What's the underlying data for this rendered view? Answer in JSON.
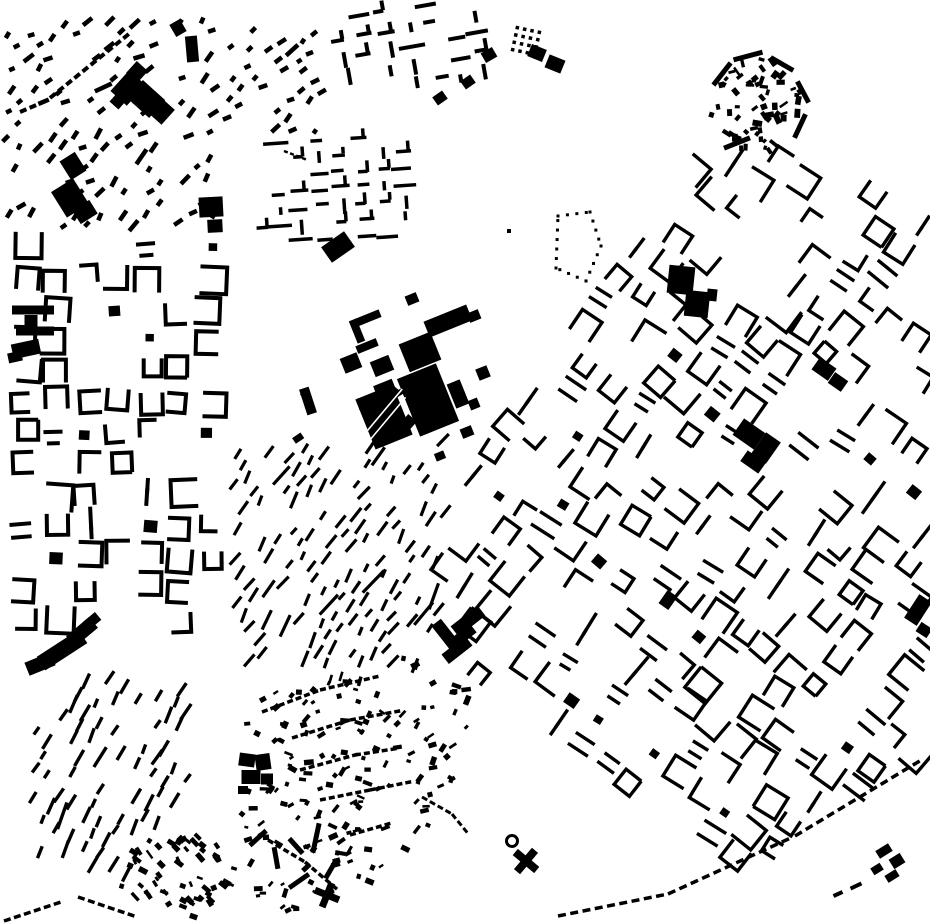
{
  "map": {
    "type": "figure-ground-building-footprints",
    "width": 930,
    "height": 924,
    "background": "#ffffff",
    "building_color": "#000000",
    "districts": [
      {
        "name": "topleft-scatter",
        "type": "bars",
        "seed": 11,
        "bbox": [
          5,
          15,
          210,
          218
        ],
        "grid_angle": -42,
        "cell": [
          17,
          15
        ],
        "bar": [
          9,
          4.5
        ],
        "bar_angle": -42,
        "bar_angle_jitter": 26,
        "density": 0.5
      },
      {
        "name": "topleft-east-cluster",
        "type": "bars",
        "seed": 12,
        "bbox": [
          226,
          22,
          96,
          114
        ],
        "grid_angle": -38,
        "cell": [
          15,
          13
        ],
        "bar": [
          7,
          4.5
        ],
        "bar_angle": -38,
        "bar_angle_jitter": 20,
        "density": 0.52
      },
      {
        "name": "topcenter-bars",
        "type": "bars_cross",
        "seed": 13,
        "bbox": [
          336,
          4,
          150,
          84
        ],
        "grid_angle": -10,
        "cell": [
          23,
          19
        ],
        "bar_len": 18,
        "bar_th": 4,
        "density": 0.85
      },
      {
        "name": "north-maze",
        "type": "bars_cross",
        "seed": 14,
        "bbox": [
          262,
          136,
          158,
          104
        ],
        "grid_angle": -4,
        "cell": [
          21,
          17
        ],
        "bar_len": 17,
        "bar_th": 3.5,
        "density": 0.82
      },
      {
        "name": "village-core-ne",
        "type": "scatter",
        "seed": 15,
        "ellipse": [
          757,
          104,
          48,
          50
        ],
        "count": 64,
        "size": [
          6.5,
          4
        ],
        "angle": 0,
        "angle_jitter": 90
      },
      {
        "name": "west-perimeter",
        "type": "perimeter",
        "seed": 16,
        "bbox": [
          5,
          243,
          226,
          380
        ],
        "grid_angle": 0,
        "cell": [
          31,
          31
        ],
        "block": 22,
        "stroke": 4,
        "density": 0.74,
        "dash_ratio": 0.22
      },
      {
        "name": "center-hatch",
        "type": "bars",
        "seed": 17,
        "bbox": [
          232,
          438,
          214,
          228
        ],
        "grid_angle": -27,
        "cell": [
          16,
          13.5
        ],
        "bar": [
          13,
          3.2
        ],
        "bar_angle": -58,
        "bar_angle_jitter": 13,
        "density": 0.55
      },
      {
        "name": "main-fabric",
        "type": "perimeter",
        "seed": 18,
        "polygon": [
          [
            426,
            565
          ],
          [
            500,
            420
          ],
          [
            548,
            335
          ],
          [
            600,
            255
          ],
          [
            648,
            215
          ],
          [
            698,
            150
          ],
          [
            745,
            148
          ],
          [
            800,
            160
          ],
          [
            930,
            205
          ],
          [
            930,
            758
          ],
          [
            845,
            800
          ],
          [
            790,
            838
          ],
          [
            745,
            868
          ],
          [
            690,
            852
          ],
          [
            600,
            798
          ],
          [
            520,
            725
          ],
          [
            452,
            648
          ]
        ],
        "grid_angle": 36,
        "cell": [
          31,
          31
        ],
        "block": 21,
        "stroke": 3.4,
        "density": 0.68,
        "dash_ratio": 0.3
      },
      {
        "name": "southwest-rows",
        "type": "bars",
        "seed": 19,
        "polygon": [
          [
            25,
            742
          ],
          [
            95,
            672
          ],
          [
            186,
            690
          ],
          [
            190,
            784
          ],
          [
            130,
            882
          ],
          [
            38,
            854
          ]
        ],
        "grid_angle": 32,
        "cell": [
          17,
          14
        ],
        "bar": [
          14,
          3.4
        ],
        "bar_angle": -62,
        "bar_angle_jitter": 9,
        "density": 0.62
      },
      {
        "name": "south-village",
        "type": "scatter",
        "seed": 20,
        "polygon": [
          [
            255,
            700
          ],
          [
            330,
            668
          ],
          [
            420,
            652
          ],
          [
            468,
            682
          ],
          [
            470,
            770
          ],
          [
            425,
            855
          ],
          [
            345,
            915
          ],
          [
            262,
            915
          ],
          [
            238,
            835
          ],
          [
            233,
            765
          ]
        ],
        "count": 175,
        "size": [
          6.5,
          3.8
        ],
        "angle": -20,
        "angle_jitter": 55
      },
      {
        "name": "south-corner-cluster",
        "type": "scatter",
        "seed": 21,
        "ellipse": [
          178,
          876,
          60,
          44
        ],
        "count": 58,
        "size": [
          7,
          4
        ],
        "angle": 42,
        "angle_jitter": 26
      },
      {
        "name": "center-gap-squares",
        "type": "scatter",
        "seed": 22,
        "bbox": [
          292,
          384,
          130,
          86
        ],
        "count": 7,
        "size": [
          10,
          9
        ],
        "angle": -20,
        "angle_jitter": 30
      }
    ],
    "landmarks": {
      "rects": [
        [
          448,
          321,
          46,
          17,
          -22
        ],
        [
          368,
          318,
          26,
          8,
          -22
        ],
        [
          357,
          331,
          8,
          24,
          -22
        ],
        [
          367,
          346,
          22,
          8,
          -22
        ],
        [
          351,
          363,
          18,
          16,
          -22
        ],
        [
          382,
          366,
          20,
          16,
          -22
        ],
        [
          385,
          389,
          20,
          14,
          -22
        ],
        [
          420,
          352,
          34,
          30,
          -22
        ],
        [
          428,
          400,
          42,
          62,
          -22
        ],
        [
          458,
          394,
          14,
          26,
          -22
        ],
        [
          474,
          316,
          12,
          10,
          -22
        ],
        [
          483,
          373,
          12,
          12,
          -22
        ],
        [
          474,
          404,
          10,
          10,
          -22
        ],
        [
          467,
          432,
          12,
          10,
          -22
        ],
        [
          440,
          456,
          10,
          8,
          -22
        ],
        [
          412,
          299,
          12,
          10,
          -22
        ],
        [
          368,
          404,
          18,
          9,
          -22
        ],
        [
          128,
          88,
          22,
          28,
          42
        ],
        [
          146,
          99,
          30,
          24,
          42
        ],
        [
          137,
          72,
          15,
          16,
          42
        ],
        [
          160,
          110,
          22,
          20,
          42
        ],
        [
          118,
          101,
          12,
          12,
          42
        ],
        [
          73,
          166,
          18,
          22,
          -32
        ],
        [
          70,
          198,
          26,
          30,
          -32
        ],
        [
          85,
          212,
          20,
          16,
          -32
        ],
        [
          192,
          49,
          12,
          26,
          -5
        ],
        [
          211,
          207,
          24,
          20,
          -3
        ],
        [
          215,
          226,
          15,
          13,
          -3
        ],
        [
          178,
          28,
          12,
          14,
          -30
        ],
        [
          33,
          310,
          42,
          9,
          0
        ],
        [
          31,
          321,
          13,
          12,
          0
        ],
        [
          35,
          331,
          38,
          9,
          0
        ],
        [
          26,
          349,
          28,
          15,
          -12
        ],
        [
          15,
          357,
          14,
          10,
          -12
        ],
        [
          62,
          650,
          50,
          16,
          -33
        ],
        [
          40,
          664,
          28,
          14,
          -22
        ],
        [
          82,
          632,
          30,
          14,
          -40
        ],
        [
          92,
          621,
          16,
          10,
          -40
        ],
        [
          468,
          621,
          34,
          13,
          -38
        ],
        [
          463,
          636,
          26,
          11,
          -38
        ],
        [
          457,
          650,
          30,
          12,
          -38
        ],
        [
          446,
          635,
          12,
          32,
          -38
        ],
        [
          749,
          434,
          26,
          20,
          35
        ],
        [
          766,
          448,
          18,
          26,
          35
        ],
        [
          753,
          462,
          22,
          13,
          35
        ],
        [
          824,
          369,
          20,
          15,
          35
        ],
        [
          838,
          382,
          16,
          13,
          35
        ],
        [
          918,
          610,
          15,
          28,
          33
        ],
        [
          924,
          630,
          13,
          11,
          33
        ],
        [
          681,
          280,
          26,
          28,
          6
        ],
        [
          697,
          304,
          24,
          26,
          6
        ],
        [
          712,
          295,
          10,
          12,
          6
        ],
        [
          537,
          53,
          16,
          13,
          22
        ],
        [
          555,
          64,
          17,
          14,
          22
        ],
        [
          338,
          247,
          28,
          19,
          -35
        ],
        [
          308,
          401,
          10,
          27,
          -18
        ],
        [
          440,
          98,
          12,
          10,
          -35
        ],
        [
          468,
          82,
          12,
          10,
          -35
        ],
        [
          489,
          55,
          13,
          11,
          -30
        ],
        [
          722,
          74,
          28,
          5,
          -52
        ],
        [
          748,
          56,
          30,
          5,
          -15
        ],
        [
          782,
          64,
          26,
          5,
          30
        ],
        [
          803,
          92,
          24,
          5,
          62
        ],
        [
          800,
          126,
          26,
          5,
          115
        ],
        [
          737,
          143,
          28,
          5,
          -22
        ],
        [
          668,
          600,
          12,
          16,
          35
        ],
        [
          884,
          851,
          15,
          9,
          -32
        ],
        [
          897,
          861,
          13,
          11,
          -32
        ],
        [
          877,
          869,
          11,
          8,
          -32
        ],
        [
          892,
          876,
          13,
          8,
          -32
        ],
        [
          856,
          886,
          12,
          4,
          -25
        ],
        [
          838,
          894,
          10,
          4,
          -25
        ],
        [
          258,
          838,
          22,
          5,
          -42
        ],
        [
          276,
          858,
          5,
          22,
          -10
        ],
        [
          296,
          846,
          20,
          5,
          48
        ],
        [
          316,
          838,
          5,
          30,
          12
        ],
        [
          299,
          881,
          24,
          5,
          -35
        ],
        [
          331,
          869,
          5,
          22,
          30
        ],
        [
          247,
          760,
          16,
          13,
          8
        ],
        [
          263,
          762,
          15,
          16,
          -8
        ],
        [
          251,
          777,
          19,
          14,
          0
        ],
        [
          267,
          779,
          12,
          11,
          0
        ],
        [
          243,
          790,
          10,
          8,
          0
        ],
        [
          509,
          231,
          4,
          4,
          0
        ]
      ],
      "striped_rects": [
        {
          "cx": 384,
          "cy": 417,
          "w": 40,
          "h": 54,
          "angle": -22,
          "stripes": 2,
          "stripe_angle": -50
        }
      ],
      "crosses": [
        {
          "cx": 327,
          "cy": 895,
          "arm": 26,
          "th": 7,
          "angle": 22
        },
        {
          "cx": 526,
          "cy": 861,
          "arm": 28,
          "th": 8,
          "angle": 40
        }
      ],
      "rings": [
        {
          "cx": 512,
          "cy": 841,
          "r": 5.5,
          "stroke": 3
        }
      ]
    },
    "dash_strings": [
      {
        "name": "nw-street-row",
        "points": [
          [
            50,
            98
          ],
          [
            130,
            33
          ]
        ],
        "dash": [
          7,
          4
        ],
        "gap": 3.5
      },
      {
        "name": "nw-street-row-2",
        "points": [
          [
            20,
            112
          ],
          [
            48,
            100
          ]
        ],
        "dash": [
          7,
          4
        ],
        "gap": 3.5
      },
      {
        "name": "se-boundary-row",
        "points": [
          [
            558,
            916
          ],
          [
            668,
            894
          ],
          [
            795,
            836
          ],
          [
            918,
            762
          ]
        ],
        "dash": [
          8,
          3.5
        ],
        "gap": 4.5
      },
      {
        "name": "sw-corner-row-1",
        "points": [
          [
            78,
            897
          ],
          [
            140,
            918
          ]
        ],
        "dash": [
          7,
          3.5
        ],
        "gap": 3.5
      },
      {
        "name": "sw-corner-row-2",
        "points": [
          [
            4,
            921
          ],
          [
            58,
            903
          ]
        ],
        "dash": [
          7,
          3.5
        ],
        "gap": 3.5
      },
      {
        "name": "south-curve-row",
        "points": [
          [
            422,
            797
          ],
          [
            452,
            814
          ],
          [
            470,
            836
          ]
        ],
        "dash": [
          6,
          3
        ],
        "gap": 3
      },
      {
        "name": "maze-zigzag-row",
        "points": [
          [
            284,
            151
          ],
          [
            310,
            161
          ]
        ],
        "dash": [
          4,
          2.5
        ],
        "gap": 2.5
      },
      {
        "name": "village-lane-1",
        "points": [
          [
            262,
            712
          ],
          [
            320,
            690
          ],
          [
            380,
            676
          ]
        ],
        "dash": [
          6,
          3.5
        ],
        "gap": 3
      },
      {
        "name": "village-lane-2",
        "points": [
          [
            292,
            738
          ],
          [
            350,
            720
          ],
          [
            405,
            710
          ]
        ],
        "dash": [
          6,
          3.5
        ],
        "gap": 3
      },
      {
        "name": "village-lane-3",
        "points": [
          [
            300,
            770
          ],
          [
            355,
            755
          ],
          [
            400,
            748
          ]
        ],
        "dash": [
          6,
          3.5
        ],
        "gap": 3
      },
      {
        "name": "village-lane-4",
        "points": [
          [
            320,
            800
          ],
          [
            370,
            790
          ],
          [
            410,
            782
          ]
        ],
        "dash": [
          6,
          3.5
        ],
        "gap": 3
      },
      {
        "name": "village-lane-5",
        "points": [
          [
            350,
            835
          ],
          [
            395,
            822
          ]
        ],
        "dash": [
          6,
          3.5
        ],
        "gap": 3
      },
      {
        "name": "village-lane-6",
        "points": [
          [
            268,
            840
          ],
          [
            305,
            862
          ],
          [
            338,
            890
          ]
        ],
        "dash": [
          6,
          3.5
        ],
        "gap": 3
      }
    ],
    "dot_grids": [
      {
        "cx": 526,
        "cy": 41,
        "cols": 4,
        "rows": 4,
        "pitch": 7.5,
        "dot": 3.5,
        "angle": 12
      }
    ],
    "dot_outlines": [
      {
        "points": [
          [
            558,
            216
          ],
          [
            590,
            212
          ],
          [
            601,
            246
          ],
          [
            586,
            281
          ],
          [
            556,
            268
          ],
          [
            558,
            216
          ]
        ],
        "dot": 3,
        "gap": 6.5
      }
    ]
  }
}
